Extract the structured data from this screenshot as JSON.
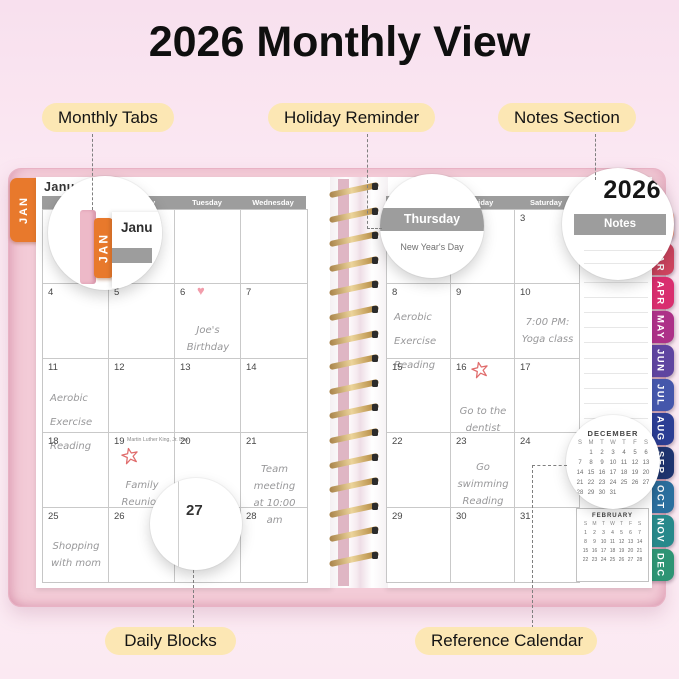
{
  "title": "2026 Monthly View",
  "callouts": {
    "monthly_tabs": "Monthly Tabs",
    "holiday_reminder": "Holiday Reminder",
    "notes_section": "Notes Section",
    "daily_blocks": "Daily Blocks",
    "reference_calendar": "Reference Calendar"
  },
  "planner": {
    "year": "2026",
    "month_label": "January",
    "jan_tab_label": "JAN",
    "notes_label": "Notes",
    "day_headers_left": [
      "Sunday",
      "Monday",
      "Tuesday",
      "Wednesday"
    ],
    "day_headers_right": [
      "Thursday",
      "Friday",
      "Saturday"
    ],
    "zoom": {
      "jan_tab_label": "JAN",
      "jan_page_snippet": "Janu",
      "thursday_label": "Thursday",
      "holiday_text": "New Year's Day",
      "day_label": "27"
    },
    "left_cells": [
      {
        "date": ""
      },
      {
        "date": ""
      },
      {
        "date": ""
      },
      {
        "date": ""
      },
      {
        "date": "4"
      },
      {
        "date": "5"
      },
      {
        "date": "6",
        "doodle": "heart",
        "align": "ctr",
        "pt": 26,
        "lines": [
          "Joe's Birthday"
        ]
      },
      {
        "date": "7"
      },
      {
        "date": "11",
        "spread": true,
        "pt": 16,
        "lines": [
          "Aerobic Exercise",
          "Reading"
        ]
      },
      {
        "date": "12"
      },
      {
        "date": "13"
      },
      {
        "date": "14"
      },
      {
        "date": "18"
      },
      {
        "date": "19",
        "holiday": "Martin Luther King, Jr. Day",
        "doodle": "star",
        "star_x": 12,
        "star_y": 14,
        "align": "ctr",
        "pt": 32,
        "lines": [
          "Family Reunion"
        ]
      },
      {
        "date": "20"
      },
      {
        "date": "21",
        "align": "ctr",
        "pt": 16,
        "lines": [
          "Team meeting",
          "at 10:00 am"
        ]
      },
      {
        "date": "25",
        "align": "ctr",
        "pt": 18,
        "lines": [
          "Shopping",
          "with mom"
        ]
      },
      {
        "date": "26"
      },
      {
        "date": "27"
      },
      {
        "date": "28"
      }
    ],
    "right_cells": [
      {
        "date": ""
      },
      {
        "date": ""
      },
      {
        "date": "3"
      },
      {
        "date": "8",
        "spread": true,
        "pt": 10,
        "lines": [
          "Aerobic Exercise",
          "Reading"
        ]
      },
      {
        "date": "9"
      },
      {
        "date": "10",
        "align": "ctr",
        "pt": 18,
        "lines": [
          "7:00 PM:",
          "Yoga class"
        ]
      },
      {
        "date": "15"
      },
      {
        "date": "16",
        "doodle": "star",
        "star_x": 20,
        "star_y": 2,
        "align": "ctr",
        "pt": 32,
        "lines": [
          "Go to the",
          "dentist"
        ]
      },
      {
        "date": "17"
      },
      {
        "date": "22"
      },
      {
        "date": "23",
        "align": "ctr",
        "pt": 14,
        "spread2": true,
        "lines": [
          "Go swimming",
          "Reading"
        ]
      },
      {
        "date": "24"
      },
      {
        "date": "29"
      },
      {
        "date": "30"
      },
      {
        "date": "31"
      }
    ],
    "month_tabs": [
      {
        "label": "FEB",
        "color": "#f0977f"
      },
      {
        "label": "MAR",
        "color": "#cf4560"
      },
      {
        "label": "APR",
        "color": "#d92e6f"
      },
      {
        "label": "MAY",
        "color": "#ad3188"
      },
      {
        "label": "JUN",
        "color": "#5f45a0"
      },
      {
        "label": "JUL",
        "color": "#4557ab"
      },
      {
        "label": "AUG",
        "color": "#2c3e94"
      },
      {
        "label": "SEP",
        "color": "#1f3570"
      },
      {
        "label": "OCT",
        "color": "#2b6f9e"
      },
      {
        "label": "NOV",
        "color": "#27898b"
      },
      {
        "label": "DEC",
        "color": "#2e9474"
      }
    ],
    "mini_calendars": [
      {
        "title": "DECEMBER",
        "headers": [
          "S",
          "M",
          "T",
          "W",
          "T",
          "F",
          "S"
        ],
        "weeks": [
          [
            "",
            "1",
            "2",
            "3",
            "4",
            "5",
            "6"
          ],
          [
            "7",
            "8",
            "9",
            "10",
            "11",
            "12",
            "13"
          ],
          [
            "14",
            "15",
            "16",
            "17",
            "18",
            "19",
            "20"
          ],
          [
            "21",
            "22",
            "23",
            "24",
            "25",
            "26",
            "27"
          ],
          [
            "28",
            "29",
            "30",
            "31",
            "",
            "",
            ""
          ]
        ]
      },
      {
        "title": "FEBRUARY",
        "headers": [
          "S",
          "M",
          "T",
          "W",
          "T",
          "F",
          "S"
        ],
        "weeks": [
          [
            "1",
            "2",
            "3",
            "4",
            "5",
            "6",
            "7"
          ],
          [
            "8",
            "9",
            "10",
            "11",
            "12",
            "13",
            "14"
          ],
          [
            "15",
            "16",
            "17",
            "18",
            "19",
            "20",
            "21"
          ],
          [
            "22",
            "23",
            "24",
            "25",
            "26",
            "27",
            "28"
          ]
        ]
      }
    ],
    "accent_colors": {
      "cover_pink": "#f3cbd7",
      "jan_tab_orange": "#e8792c",
      "header_gray": "#9d9d9d",
      "pill_yellow": "#fce7b4",
      "doodle_red": "#e06c6c",
      "heart_pink": "#f29dab"
    }
  }
}
